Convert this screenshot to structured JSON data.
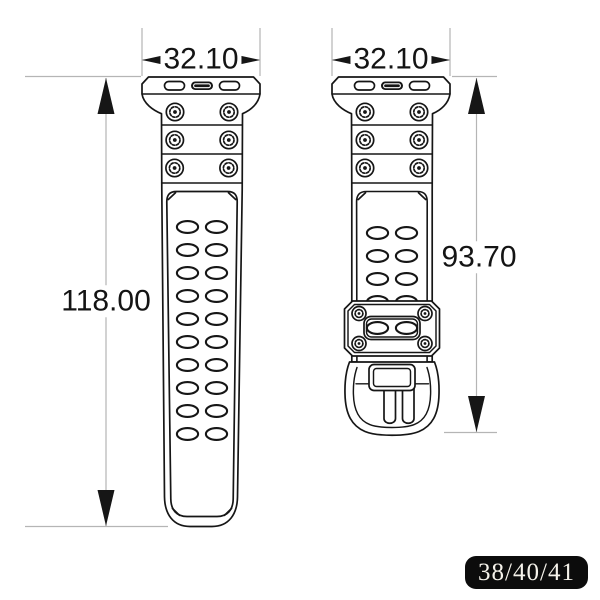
{
  "drawing": {
    "left_strap": {
      "width_mm": "32.10",
      "length_mm": "118.00"
    },
    "right_strap": {
      "width_mm": "32.10",
      "length_mm": "93.70"
    }
  },
  "badge": {
    "label": "38/40/41"
  },
  "colors": {
    "line": "#161616",
    "dim_line": "#b5b5b5",
    "badge_bg": "#0c0c0c",
    "badge_text": "#f5f2ea"
  }
}
